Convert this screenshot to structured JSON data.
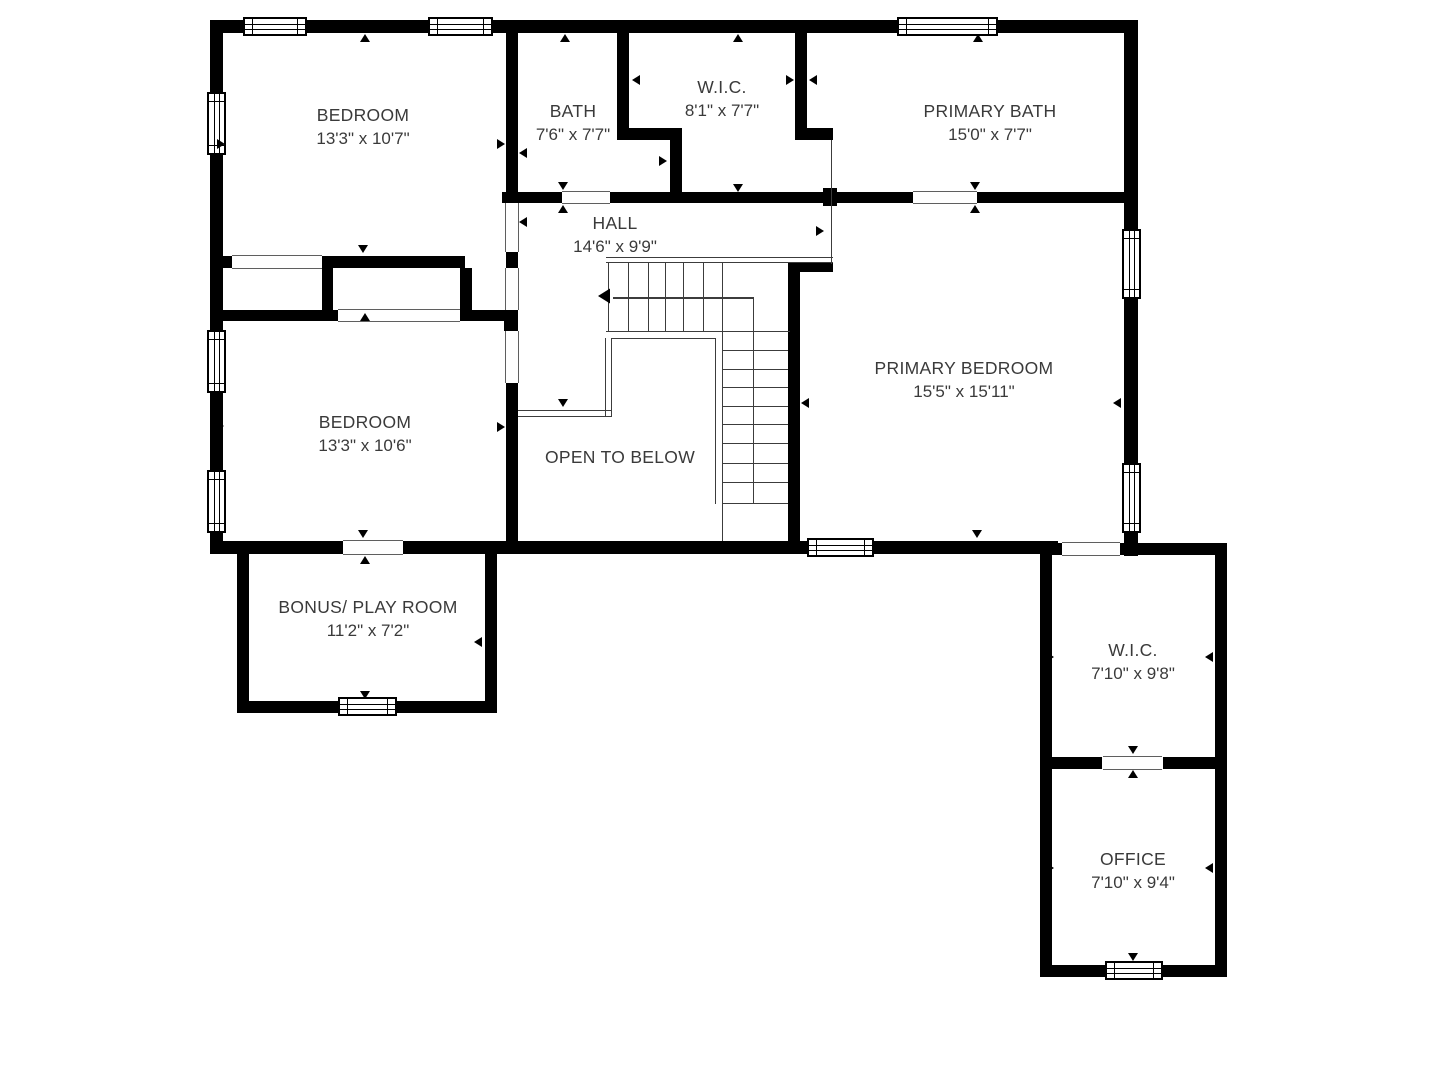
{
  "plan": {
    "colors": {
      "wall": "#000000",
      "thin_line": "#3c3c3c",
      "text": "#3a3a3a",
      "background": "#ffffff"
    },
    "rooms": [
      {
        "label": "BEDROOM",
        "dims": "13'3\" x 10'7\"",
        "x": 363,
        "y": 115
      },
      {
        "label": "BATH",
        "dims": "7'6\" x 7'7\"",
        "x": 573,
        "y": 111
      },
      {
        "label": "W.I.C.",
        "dims": "8'1\" x 7'7\"",
        "x": 722,
        "y": 87
      },
      {
        "label": "PRIMARY BATH",
        "dims": "15'0\" x 7'7\"",
        "x": 990,
        "y": 111
      },
      {
        "label": "HALL",
        "dims": "14'6\" x 9'9\"",
        "x": 615,
        "y": 223
      },
      {
        "label": "PRIMARY BEDROOM",
        "dims": "15'5\" x 15'11\"",
        "x": 964,
        "y": 368
      },
      {
        "label": "BEDROOM",
        "dims": "13'3\" x 10'6\"",
        "x": 365,
        "y": 422
      },
      {
        "label": "OPEN TO BELOW",
        "dims": "",
        "x": 620,
        "y": 457
      },
      {
        "label": "BONUS/ PLAY ROOM",
        "dims": "11'2\" x 7'2\"",
        "x": 368,
        "y": 607
      },
      {
        "label": "W.I.C.",
        "dims": "7'10\" x 9'8\"",
        "x": 1133,
        "y": 650
      },
      {
        "label": "OFFICE",
        "dims": "7'10\" x 9'4\"",
        "x": 1133,
        "y": 859
      }
    ],
    "walls": [
      [
        210,
        20,
        928,
        13
      ],
      [
        210,
        20,
        13,
        534
      ],
      [
        1124,
        20,
        14,
        536
      ],
      [
        210,
        541,
        848,
        13
      ],
      [
        506,
        20,
        12,
        183
      ],
      [
        506,
        252,
        12,
        16
      ],
      [
        504,
        310,
        14,
        21
      ],
      [
        506,
        383,
        12,
        158
      ],
      [
        322,
        256,
        143,
        12
      ],
      [
        223,
        256,
        10,
        12
      ],
      [
        322,
        268,
        11,
        45
      ],
      [
        223,
        310,
        115,
        11
      ],
      [
        460,
        268,
        12,
        53
      ],
      [
        460,
        310,
        57,
        11
      ],
      [
        617,
        20,
        12,
        120
      ],
      [
        629,
        128,
        53,
        12
      ],
      [
        670,
        140,
        12,
        52
      ],
      [
        795,
        20,
        12,
        120
      ],
      [
        807,
        128,
        26,
        12
      ],
      [
        502,
        192,
        60,
        11
      ],
      [
        610,
        192,
        303,
        11
      ],
      [
        977,
        192,
        147,
        11
      ],
      [
        823,
        188,
        14,
        18
      ],
      [
        788,
        263,
        12,
        278
      ],
      [
        800,
        263,
        33,
        9
      ],
      [
        1040,
        543,
        22,
        12
      ],
      [
        1120,
        543,
        107,
        12
      ],
      [
        1040,
        543,
        12,
        434
      ],
      [
        1215,
        543,
        12,
        434
      ],
      [
        1052,
        757,
        50,
        12
      ],
      [
        1163,
        757,
        52,
        12
      ],
      [
        1040,
        965,
        187,
        12
      ],
      [
        237,
        553,
        12,
        160
      ],
      [
        485,
        553,
        12,
        160
      ],
      [
        237,
        701,
        260,
        12
      ]
    ],
    "openings": [
      {
        "x": 505,
        "y": 203,
        "w": 14,
        "h": 49,
        "o": "v"
      },
      {
        "x": 505,
        "y": 268,
        "w": 14,
        "h": 42,
        "o": "v"
      },
      {
        "x": 505,
        "y": 331,
        "w": 14,
        "h": 52,
        "o": "v"
      },
      {
        "x": 232,
        "y": 255,
        "w": 90,
        "h": 14,
        "o": "h"
      },
      {
        "x": 338,
        "y": 309,
        "w": 122,
        "h": 13,
        "o": "h"
      },
      {
        "x": 343,
        "y": 540,
        "w": 60,
        "h": 15,
        "o": "h"
      },
      {
        "x": 562,
        "y": 191,
        "w": 48,
        "h": 13,
        "o": "h"
      },
      {
        "x": 913,
        "y": 191,
        "w": 64,
        "h": 13,
        "o": "h"
      },
      {
        "x": 1062,
        "y": 542,
        "w": 58,
        "h": 14,
        "o": "h"
      },
      {
        "x": 1103,
        "y": 756,
        "w": 59,
        "h": 14,
        "o": "h"
      }
    ],
    "windows": [
      {
        "x": 243,
        "y": 17,
        "w": 64,
        "h": 19,
        "o": "h"
      },
      {
        "x": 428,
        "y": 17,
        "w": 65,
        "h": 19,
        "o": "h"
      },
      {
        "x": 897,
        "y": 17,
        "w": 101,
        "h": 19,
        "o": "h"
      },
      {
        "x": 207,
        "y": 92,
        "w": 19,
        "h": 63,
        "o": "v"
      },
      {
        "x": 207,
        "y": 330,
        "w": 19,
        "h": 63,
        "o": "v"
      },
      {
        "x": 207,
        "y": 470,
        "w": 19,
        "h": 63,
        "o": "v"
      },
      {
        "x": 1122,
        "y": 229,
        "w": 19,
        "h": 70,
        "o": "v"
      },
      {
        "x": 1122,
        "y": 463,
        "w": 19,
        "h": 70,
        "o": "v"
      },
      {
        "x": 807,
        "y": 538,
        "w": 67,
        "h": 19,
        "o": "h"
      },
      {
        "x": 338,
        "y": 697,
        "w": 59,
        "h": 19,
        "o": "h"
      },
      {
        "x": 1105,
        "y": 961,
        "w": 58,
        "h": 19,
        "o": "h"
      }
    ],
    "thin_lines": [
      [
        606,
        257,
        227,
        1.4
      ],
      [
        606,
        262,
        227,
        1.4
      ],
      [
        831,
        140,
        1.4,
        124
      ],
      [
        608,
        263,
        1.2,
        68
      ],
      [
        628,
        263,
        1.2,
        68
      ],
      [
        648,
        263,
        1.2,
        68
      ],
      [
        665,
        263,
        1.2,
        68
      ],
      [
        683,
        263,
        1.2,
        68
      ],
      [
        703,
        263,
        1.2,
        68
      ],
      [
        722,
        263,
        1.2,
        278
      ],
      [
        753,
        298,
        1.2,
        206
      ],
      [
        606,
        331,
        184,
        1.4
      ],
      [
        723,
        350,
        65,
        1.2
      ],
      [
        723,
        369,
        65,
        1.2
      ],
      [
        723,
        387,
        65,
        1.2
      ],
      [
        723,
        406,
        65,
        1.2
      ],
      [
        723,
        424,
        65,
        1.2
      ],
      [
        723,
        443,
        65,
        1.2
      ],
      [
        723,
        463,
        65,
        1.2
      ],
      [
        723,
        482,
        65,
        1.2
      ],
      [
        723,
        503,
        65,
        1.2
      ],
      [
        613,
        297,
        141,
        1.5
      ],
      [
        611,
        338,
        105,
        1.4
      ],
      [
        715,
        338,
        1.4,
        166
      ],
      [
        605,
        338,
        1.4,
        79
      ],
      [
        611,
        338,
        1.4,
        79
      ],
      [
        518,
        410,
        94,
        1.4
      ],
      [
        518,
        416,
        94,
        1.4
      ]
    ],
    "arrows": [
      {
        "d": "up",
        "x": 360,
        "y": 34
      },
      {
        "d": "up",
        "x": 560,
        "y": 34
      },
      {
        "d": "up",
        "x": 733,
        "y": 34
      },
      {
        "d": "up",
        "x": 973,
        "y": 34
      },
      {
        "d": "up",
        "x": 360,
        "y": 313
      },
      {
        "d": "up",
        "x": 558,
        "y": 205
      },
      {
        "d": "up",
        "x": 970,
        "y": 205
      },
      {
        "d": "up",
        "x": 360,
        "y": 556
      },
      {
        "d": "up",
        "x": 1128,
        "y": 770
      },
      {
        "d": "down",
        "x": 358,
        "y": 245
      },
      {
        "d": "down",
        "x": 558,
        "y": 182
      },
      {
        "d": "down",
        "x": 733,
        "y": 184
      },
      {
        "d": "down",
        "x": 970,
        "y": 182
      },
      {
        "d": "down",
        "x": 558,
        "y": 399
      },
      {
        "d": "down",
        "x": 358,
        "y": 530
      },
      {
        "d": "down",
        "x": 972,
        "y": 530
      },
      {
        "d": "down",
        "x": 360,
        "y": 691
      },
      {
        "d": "down",
        "x": 1128,
        "y": 548
      },
      {
        "d": "down",
        "x": 1128,
        "y": 746
      },
      {
        "d": "down",
        "x": 1128,
        "y": 953
      },
      {
        "d": "right",
        "x": 217,
        "y": 139
      },
      {
        "d": "right",
        "x": 497,
        "y": 139
      },
      {
        "d": "right",
        "x": 216,
        "y": 421
      },
      {
        "d": "right",
        "x": 497,
        "y": 422
      },
      {
        "d": "right",
        "x": 786,
        "y": 75
      },
      {
        "d": "right",
        "x": 659,
        "y": 156
      },
      {
        "d": "right",
        "x": 816,
        "y": 226
      },
      {
        "d": "right",
        "x": 241,
        "y": 637
      },
      {
        "d": "right",
        "x": 1046,
        "y": 652
      },
      {
        "d": "right",
        "x": 1046,
        "y": 863
      },
      {
        "d": "left",
        "x": 519,
        "y": 148
      },
      {
        "d": "left",
        "x": 519,
        "y": 217
      },
      {
        "d": "left",
        "x": 632,
        "y": 75
      },
      {
        "d": "left",
        "x": 809,
        "y": 75
      },
      {
        "d": "left",
        "x": 801,
        "y": 398
      },
      {
        "d": "left",
        "x": 1113,
        "y": 398
      },
      {
        "d": "left",
        "x": 474,
        "y": 637
      },
      {
        "d": "left",
        "x": 1205,
        "y": 652
      },
      {
        "d": "left",
        "x": 1205,
        "y": 863
      },
      {
        "d": "left",
        "x": 600,
        "y": 291,
        "s": 1.5
      }
    ]
  }
}
